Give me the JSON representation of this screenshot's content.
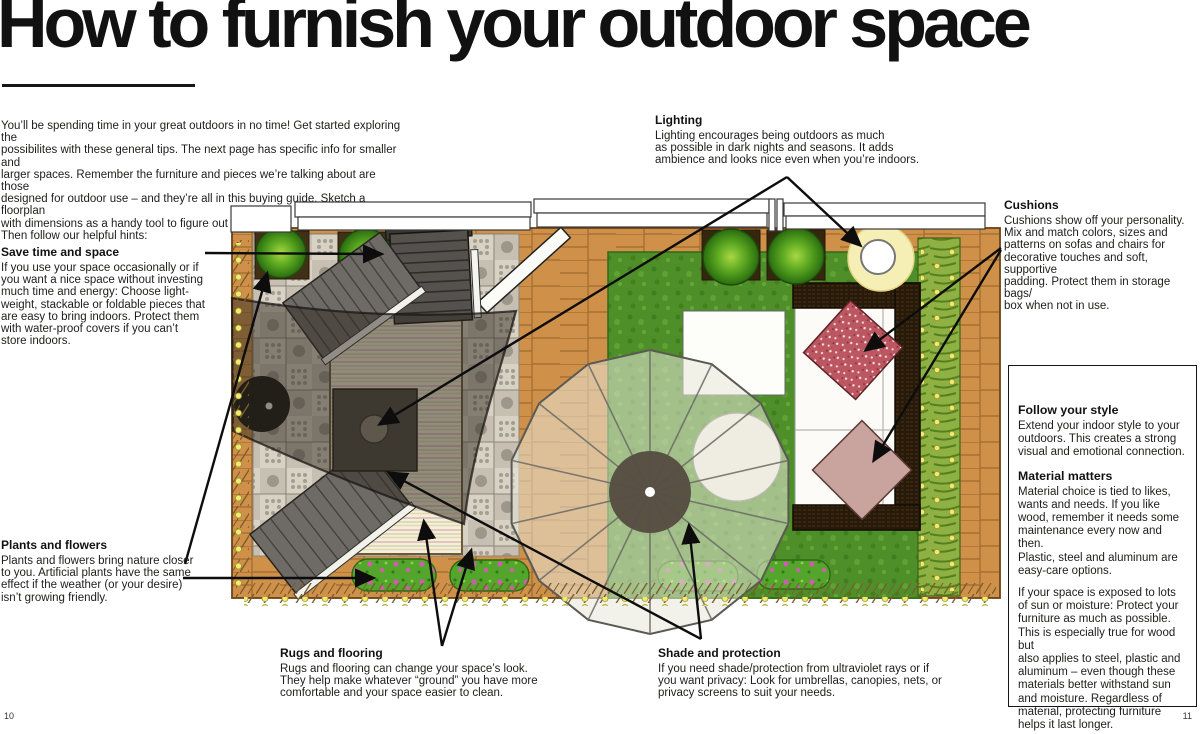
{
  "page": {
    "title": "How to furnish your outdoor space",
    "intro": "You’ll be spending time in your great outdoors in no time! Get started exploring the\npossibilites with these general tips. The next page has specific info for smaller and\nlarger spaces. Remember the furniture and pieces we’re talking about are those\ndesigned for outdoor use – and they’re all in this buying guide. Sketch a floorplan\nwith dimensions as a handy tool to figure out what fits.\nThen follow our helpful hints:",
    "page_number_left": "10",
    "page_number_right": "11"
  },
  "callouts": {
    "lighting": {
      "heading": "Lighting",
      "body": "Lighting encourages being outdoors as much\nas possible in dark nights and seasons. It adds\nambience and looks nice even when you’re indoors."
    },
    "cushions": {
      "heading": "Cushions",
      "body": "Cushions show off your personality.\nMix and match colors, sizes and\npatterns on sofas and chairs for\ndecorative touches and soft, supportive\npadding. Protect them in storage bags/\nbox when not in use."
    },
    "save_time": {
      "heading": "Save time and space",
      "body": "If you use your space occasionally or if\nyou want a nice space without investing\nmuch time and energy: Choose light-\nweight, stackable or foldable pieces that\nare easy to bring indoors. Protect them\nwith water-proof covers if you can’t\nstore indoors."
    },
    "plants": {
      "heading": "Plants and flowers",
      "body": "Plants and flowers bring nature closer\nto you. Artificial plants have the same\neffect if the weather (or your desire)\nisn’t growing friendly."
    },
    "rugs": {
      "heading": "Rugs and flooring",
      "body": "Rugs and flooring can change your space’s look.\nThey help make whatever “ground” you have more\ncomfortable and your space easier to clean."
    },
    "shade": {
      "heading": "Shade and protection",
      "body": "If you need shade/protection from ultraviolet rays or if\nyou want privacy: Look for umbrellas, canopies, nets, or\nprivacy screens to suit your needs."
    }
  },
  "style_box": {
    "follow_heading": "Follow your style",
    "follow_body": "Extend your indoor style to your\noutdoors. This creates a strong\nvisual and emotional connection.",
    "material_heading": "Material matters",
    "material_body": "Material choice is tied to likes,\nwants and needs. If you like\nwood, remember it needs some\nmaintenance every now and then.\nPlastic, steel and aluminum are\neasy-care options.",
    "material_body2": "If your space is exposed to lots\nof sun or moisture: Protect your\nfurniture as much as possible.\nThis is especially true for wood but\nalso applies to steel, plastic and\naluminum – even though these\nmaterials better withstand sun\nand moisture. Regardless of\nmaterial, protecting furniture\nhelps it last longer."
  },
  "floorplan": {
    "colors": {
      "deck": "#cf9049",
      "tile": "#d8d2c4",
      "lawn": "#4f8f2a",
      "hedge": "#8fb043",
      "rug": "#f4eedd",
      "sofa": "#271a0a",
      "red_cushion": "#bc5660",
      "pink_cushion": "#c9a39e",
      "lamp_glow": "#f6efb5",
      "flower_bed": "#54a52c",
      "flower_dot": "#cb5fa8",
      "string_light": "#efec6d",
      "umbrella": "#e9e7d8",
      "sail": "#2f2a22",
      "bush": "#63ad24",
      "callout_line": "#0d0d0d"
    }
  }
}
